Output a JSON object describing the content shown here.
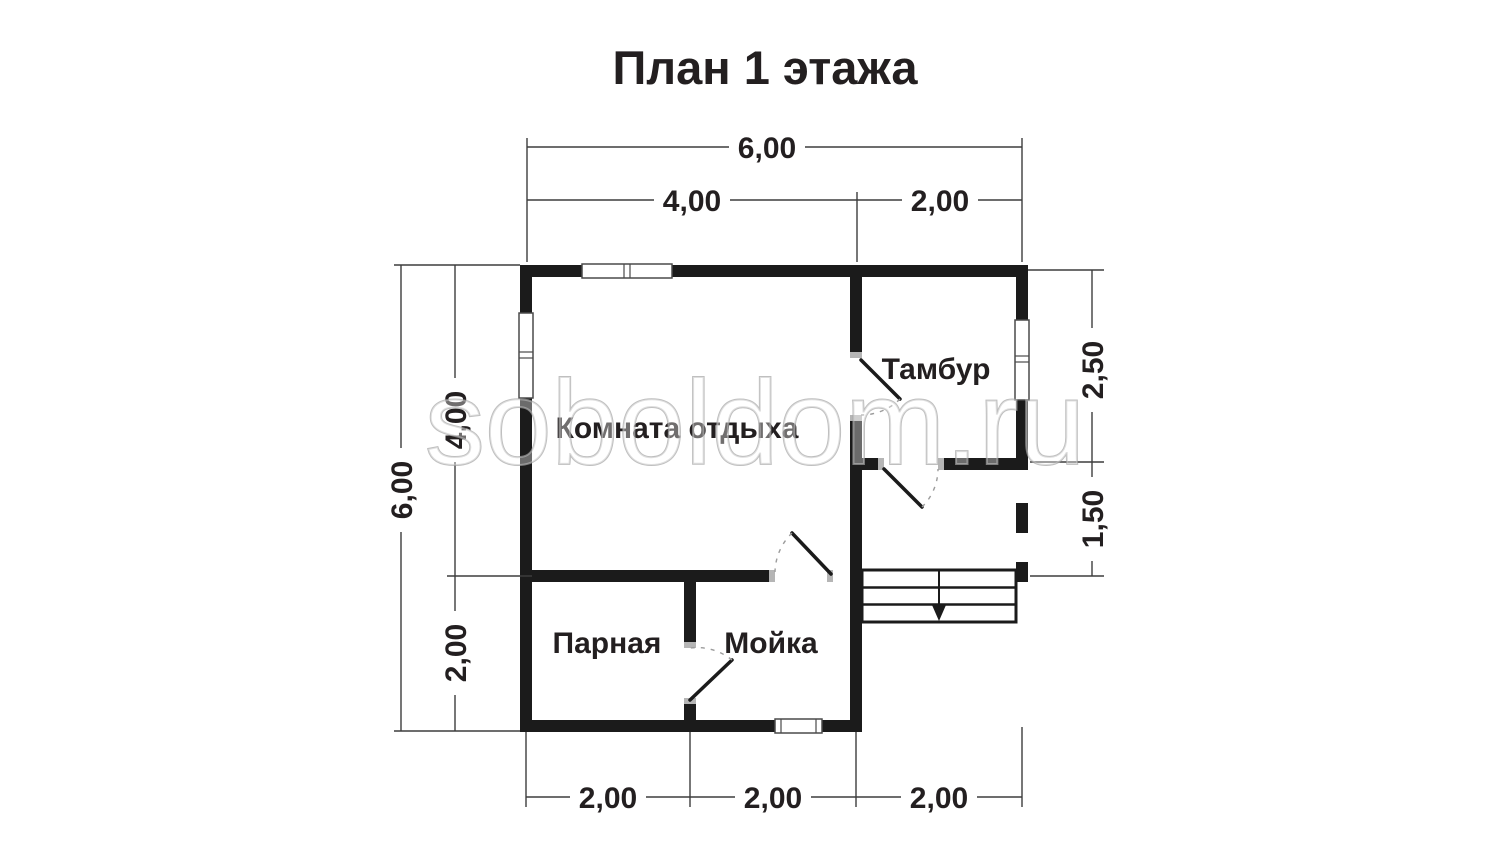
{
  "title": "План 1 этажа",
  "watermark": "soboldom.ru",
  "rooms": {
    "rest_room": "Комната отдыха",
    "vestibule": "Тамбур",
    "steam_room": "Парная",
    "wash_room": "Мойка"
  },
  "dimensions": {
    "top_total": "6,00",
    "top_left_section": "4,00",
    "top_right_section": "2,00",
    "left_total": "6,00",
    "left_upper_section": "4,00",
    "left_lower_section": "2,00",
    "right_upper_section": "2,50",
    "right_lower_section": "1,50",
    "bottom_left_section": "2,00",
    "bottom_middle_section": "2,00",
    "bottom_right_section": "2,00"
  },
  "colors": {
    "wall": "#1b1b1b",
    "dimension_line": "#3d3d3d",
    "text": "#231f20",
    "door_jamb": "#b5b5b5",
    "watermark_outline": "#a5a5a5",
    "background": "#ffffff"
  }
}
